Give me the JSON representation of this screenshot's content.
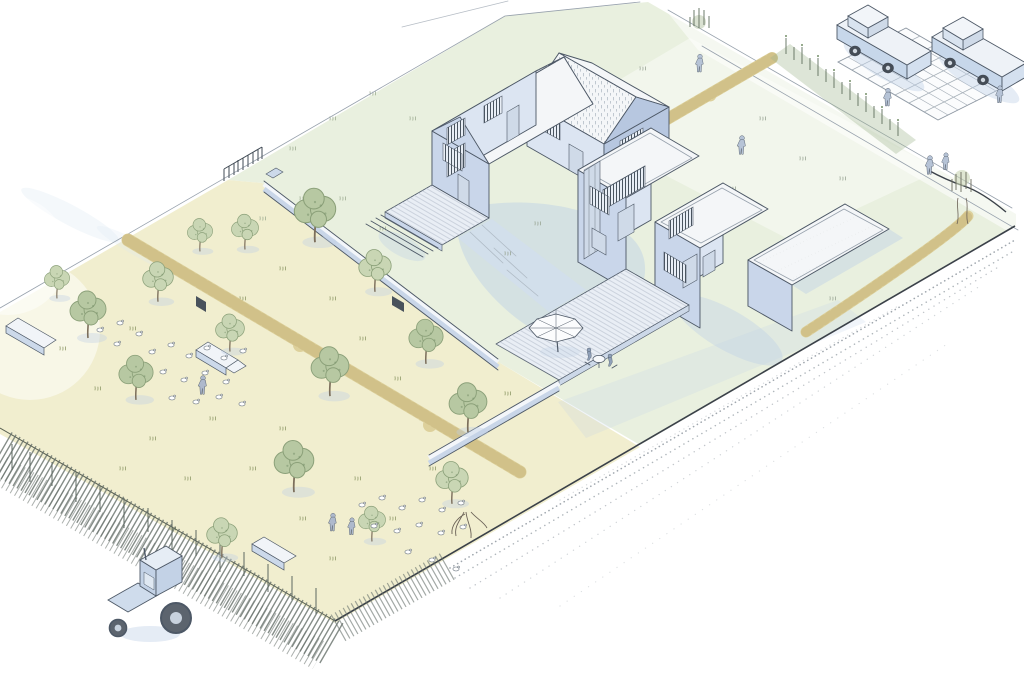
{
  "scene": {
    "title": "Hand-drawn axonometric illustration of a long garden plot",
    "description": "Watercolour concept sketch, bird's-eye axonometric view. A long rectangular plot runs from a wild meadow at the lower left to a street with parked cars at the upper right. The meadow has fruit trees, two flocks of geese, low stone benches, people and a tractor beside a reed bank. The middle garden holds a two-storey gabled house with a timber deck. Beside it stands a modern flat-roofed house with a terrace, parasol and garden furniture, plus a gravel-roofed garage. Clipped tan hedges, a perennial flower border, a gridded parking pad with two cars and a speckled gravel margin complete the scene.",
    "style": "watercolour concept sketch",
    "view": "axonometric bird's-eye",
    "areas": {
      "meadow": "Wildflower meadow with fruit trees and geese",
      "garden": "Lawn garden behind low wall and hedge",
      "gabled_house": "Two-storey gabled house with timber deck and steps",
      "modern_house": "Two-storey flat-roofed house with terrace and parasol",
      "garage": "Flat-roofed garage with gravel roof",
      "parking": "Paved parking grid with two cars",
      "border": "Perennial flower border",
      "boundary": "Gravel margin, reed bank and root edge"
    },
    "counts": {
      "houses": 2,
      "outbuildings": 1,
      "cars": 2,
      "trees": 16,
      "shrubs": 1,
      "geese": 32,
      "people": 11,
      "parasols": 1,
      "tractors": 1,
      "benches": 3,
      "hedges": 3
    }
  },
  "palette": {
    "paper": "#ffffff",
    "ink": "#4d5866",
    "ink_light": "#97a1ac",
    "wall_light": "#dce5f2",
    "wall_mid": "#c9d6ea",
    "wall_shade": "#b7c7e0",
    "roof_white": "#f4f6f8",
    "roof_hatch": "#a2adb9",
    "glass": "#cfdae8",
    "frame_dark": "#4e5a66",
    "shadow_blue": "#bfd0e6",
    "meadow_cream": "#f1eecf",
    "lawn_green": "#e7eedc",
    "tree_green_1": "#b7c8a2",
    "tree_green_2": "#c9d6b4",
    "tree_ink": "#8ba079",
    "tree_speck": "#76906a",
    "trunk": "#7c6f5c",
    "hedge_tan": "#ddd09b",
    "hedge_dark": "#b9a766",
    "car_blue": "#c7d7ea",
    "wheel_dark": "#444c56",
    "gravel": "#8f98a0",
    "reed": "#66706a",
    "stem": "#5f6e5c",
    "stem_wash": "#9fb48d",
    "figure": "#aeb9cc",
    "deck": "#e9eef5",
    "plank": "#b6c0cc"
  }
}
